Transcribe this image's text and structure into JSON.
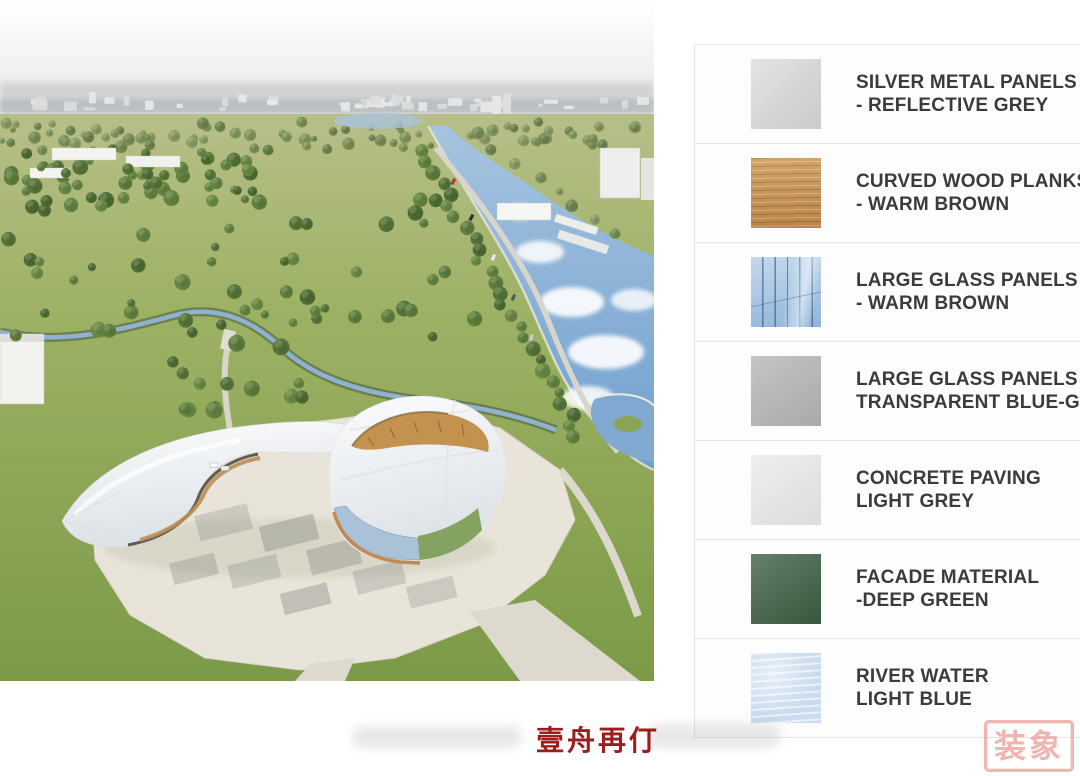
{
  "scene": {
    "alt": "Aerial architectural rendering of a curved white building with wood and glass facades on a plaza, in a riverside park surrounded by trees and white residential blocks"
  },
  "legend": {
    "text_color": "#3b3b3b",
    "divider_color": "#e3e3e3",
    "items": [
      {
        "line1": "SILVER METAL PANELS",
        "line2": "- REFLECTIVE GREY",
        "color": "#d3d5d7",
        "texture": "silver"
      },
      {
        "line1": "CURVED WOOD PLANKS",
        "line2": "- WARM BROWN",
        "color": "#c28d50",
        "texture": "wood"
      },
      {
        "line1": "LARGE GLASS PANELS",
        "line2": "- WARM BROWN",
        "color": "#aac8e5",
        "texture": "glass"
      },
      {
        "line1": "LARGE GLASS PANELS -",
        "line2": "TRANSPARENT BLUE-GREY",
        "color": "#b2b4b6",
        "texture": "plain"
      },
      {
        "line1": "CONCRETE PAVING",
        "line2": "LIGHT GREY",
        "color": "#e9eaec",
        "texture": "plain"
      },
      {
        "line1": "FACADE MATERIAL",
        "line2": "-DEEP GREEN",
        "color": "#3b5c40",
        "texture": "plain"
      },
      {
        "line1": "RIVER WATER",
        "line2": "LIGHT BLUE",
        "color": "#c9dbee",
        "texture": "water"
      }
    ]
  },
  "footer": {
    "caption": "壹舟再仃",
    "caption_color": "#9c1d1d"
  },
  "seal": {
    "characters": "装象",
    "color": "#efa9a3"
  }
}
